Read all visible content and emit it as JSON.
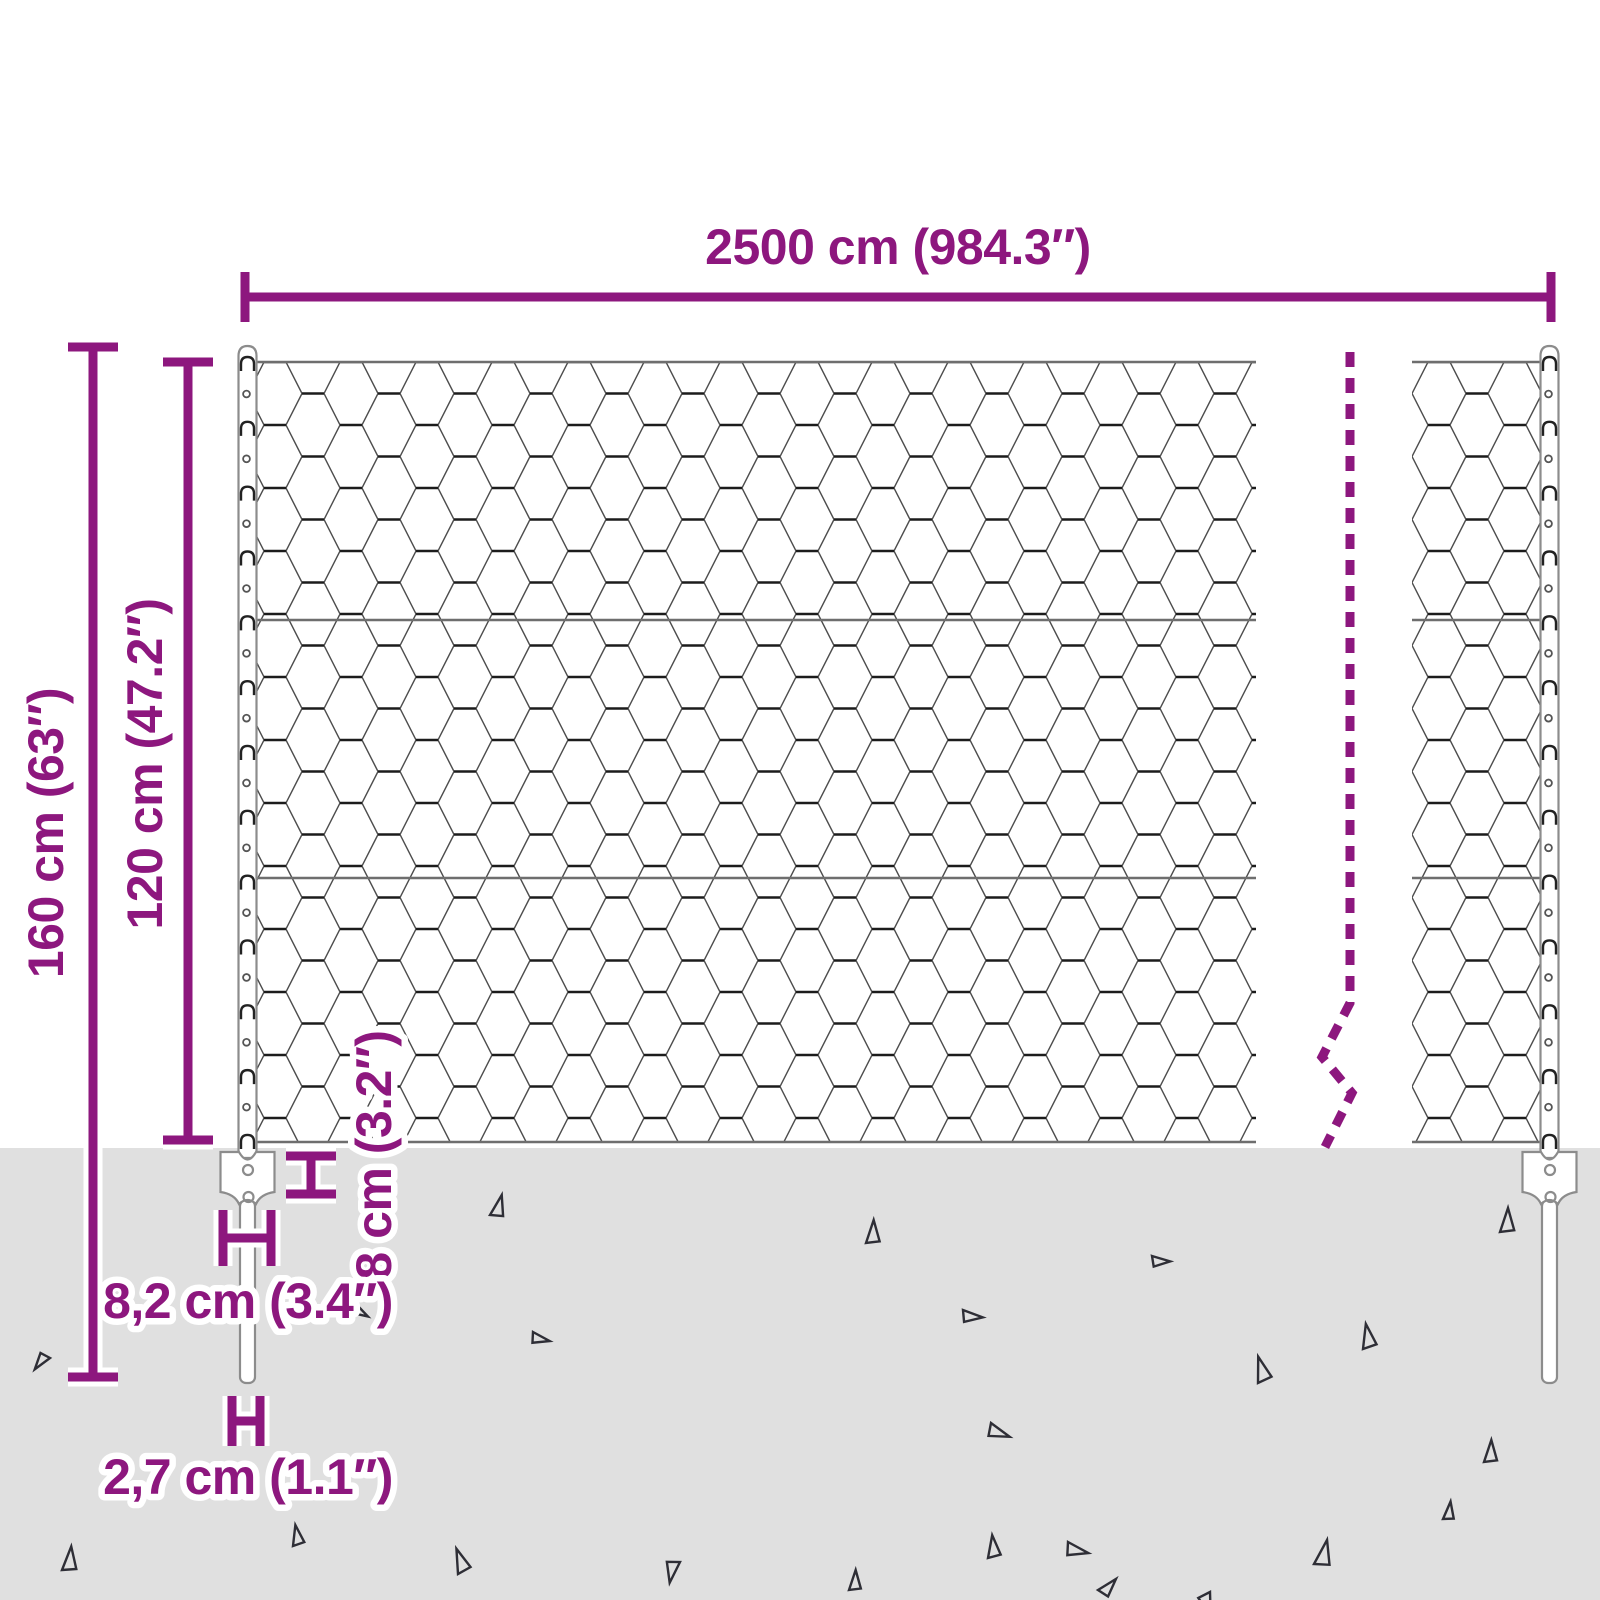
{
  "diagram": {
    "type": "fence-dimension-diagram",
    "labels": {
      "fence_width": "2500 cm (984.3″)",
      "post_height": "160 cm (63″)",
      "mesh_height": "120 cm (47.2″)",
      "anchor_height": "8 cm (3.2″)",
      "anchor_width": "8,2 cm (3.4″)",
      "spike_width": "2,7 cm (1.1″)"
    },
    "colors": {
      "accent": "#8d177e",
      "ground": "#e0e0e0",
      "mesh_line": "#4d4d4d",
      "mesh_twist": "#1c1c1c",
      "wire": "#6e6e6e",
      "post_outline": "#8c8c8c",
      "triangle": "#2e2e36",
      "halo": "#ffffff"
    },
    "posts": {
      "x": [
        247.5,
        1549.5
      ],
      "clips": {
        "start": 362,
        "step": 64.83,
        "count": 13
      },
      "holes": {
        "start": 394,
        "step": 64.83,
        "count": 12
      }
    },
    "ground_y": 1148,
    "triangles": [
      {
        "x": 490,
        "y": 1215,
        "s": 22,
        "r": 12
      },
      {
        "x": 866,
        "y": 1243,
        "s": 23,
        "r": 0
      },
      {
        "x": 1500,
        "y": 1232,
        "s": 24,
        "r": 0
      },
      {
        "x": 1152,
        "y": 1256,
        "s": 18,
        "r": 88
      },
      {
        "x": 1363,
        "y": 1349,
        "s": 24,
        "r": -12
      },
      {
        "x": 357,
        "y": 1305,
        "s": 15,
        "r": 118
      },
      {
        "x": 533,
        "y": 1332,
        "s": 18,
        "r": 100
      },
      {
        "x": 50,
        "y": 1358,
        "s": 18,
        "r": 215
      },
      {
        "x": 963,
        "y": 1310,
        "s": 20,
        "r": 92
      },
      {
        "x": 1258,
        "y": 1383,
        "s": 25,
        "r": -18
      },
      {
        "x": 991,
        "y": 1423,
        "s": 22,
        "r": 108
      },
      {
        "x": 1068,
        "y": 1542,
        "s": 22,
        "r": 100
      },
      {
        "x": 1314,
        "y": 1564,
        "s": 26,
        "r": 10
      },
      {
        "x": 849,
        "y": 1590,
        "s": 20,
        "r": 0
      },
      {
        "x": 1210,
        "y": 1592,
        "s": 22,
        "r": 160
      },
      {
        "x": 62,
        "y": 1570,
        "s": 24,
        "r": 3
      },
      {
        "x": 293,
        "y": 1546,
        "s": 20,
        "r": -12
      },
      {
        "x": 458,
        "y": 1574,
        "s": 24,
        "r": -22
      },
      {
        "x": 1484,
        "y": 1462,
        "s": 22,
        "r": 0
      },
      {
        "x": 680,
        "y": 1562,
        "s": 22,
        "r": 188
      },
      {
        "x": 988,
        "y": 1558,
        "s": 22,
        "r": -8
      },
      {
        "x": 1443,
        "y": 1519,
        "s": 18,
        "r": 5
      },
      {
        "x": 1098,
        "y": 1590,
        "s": 20,
        "r": 40
      }
    ]
  }
}
